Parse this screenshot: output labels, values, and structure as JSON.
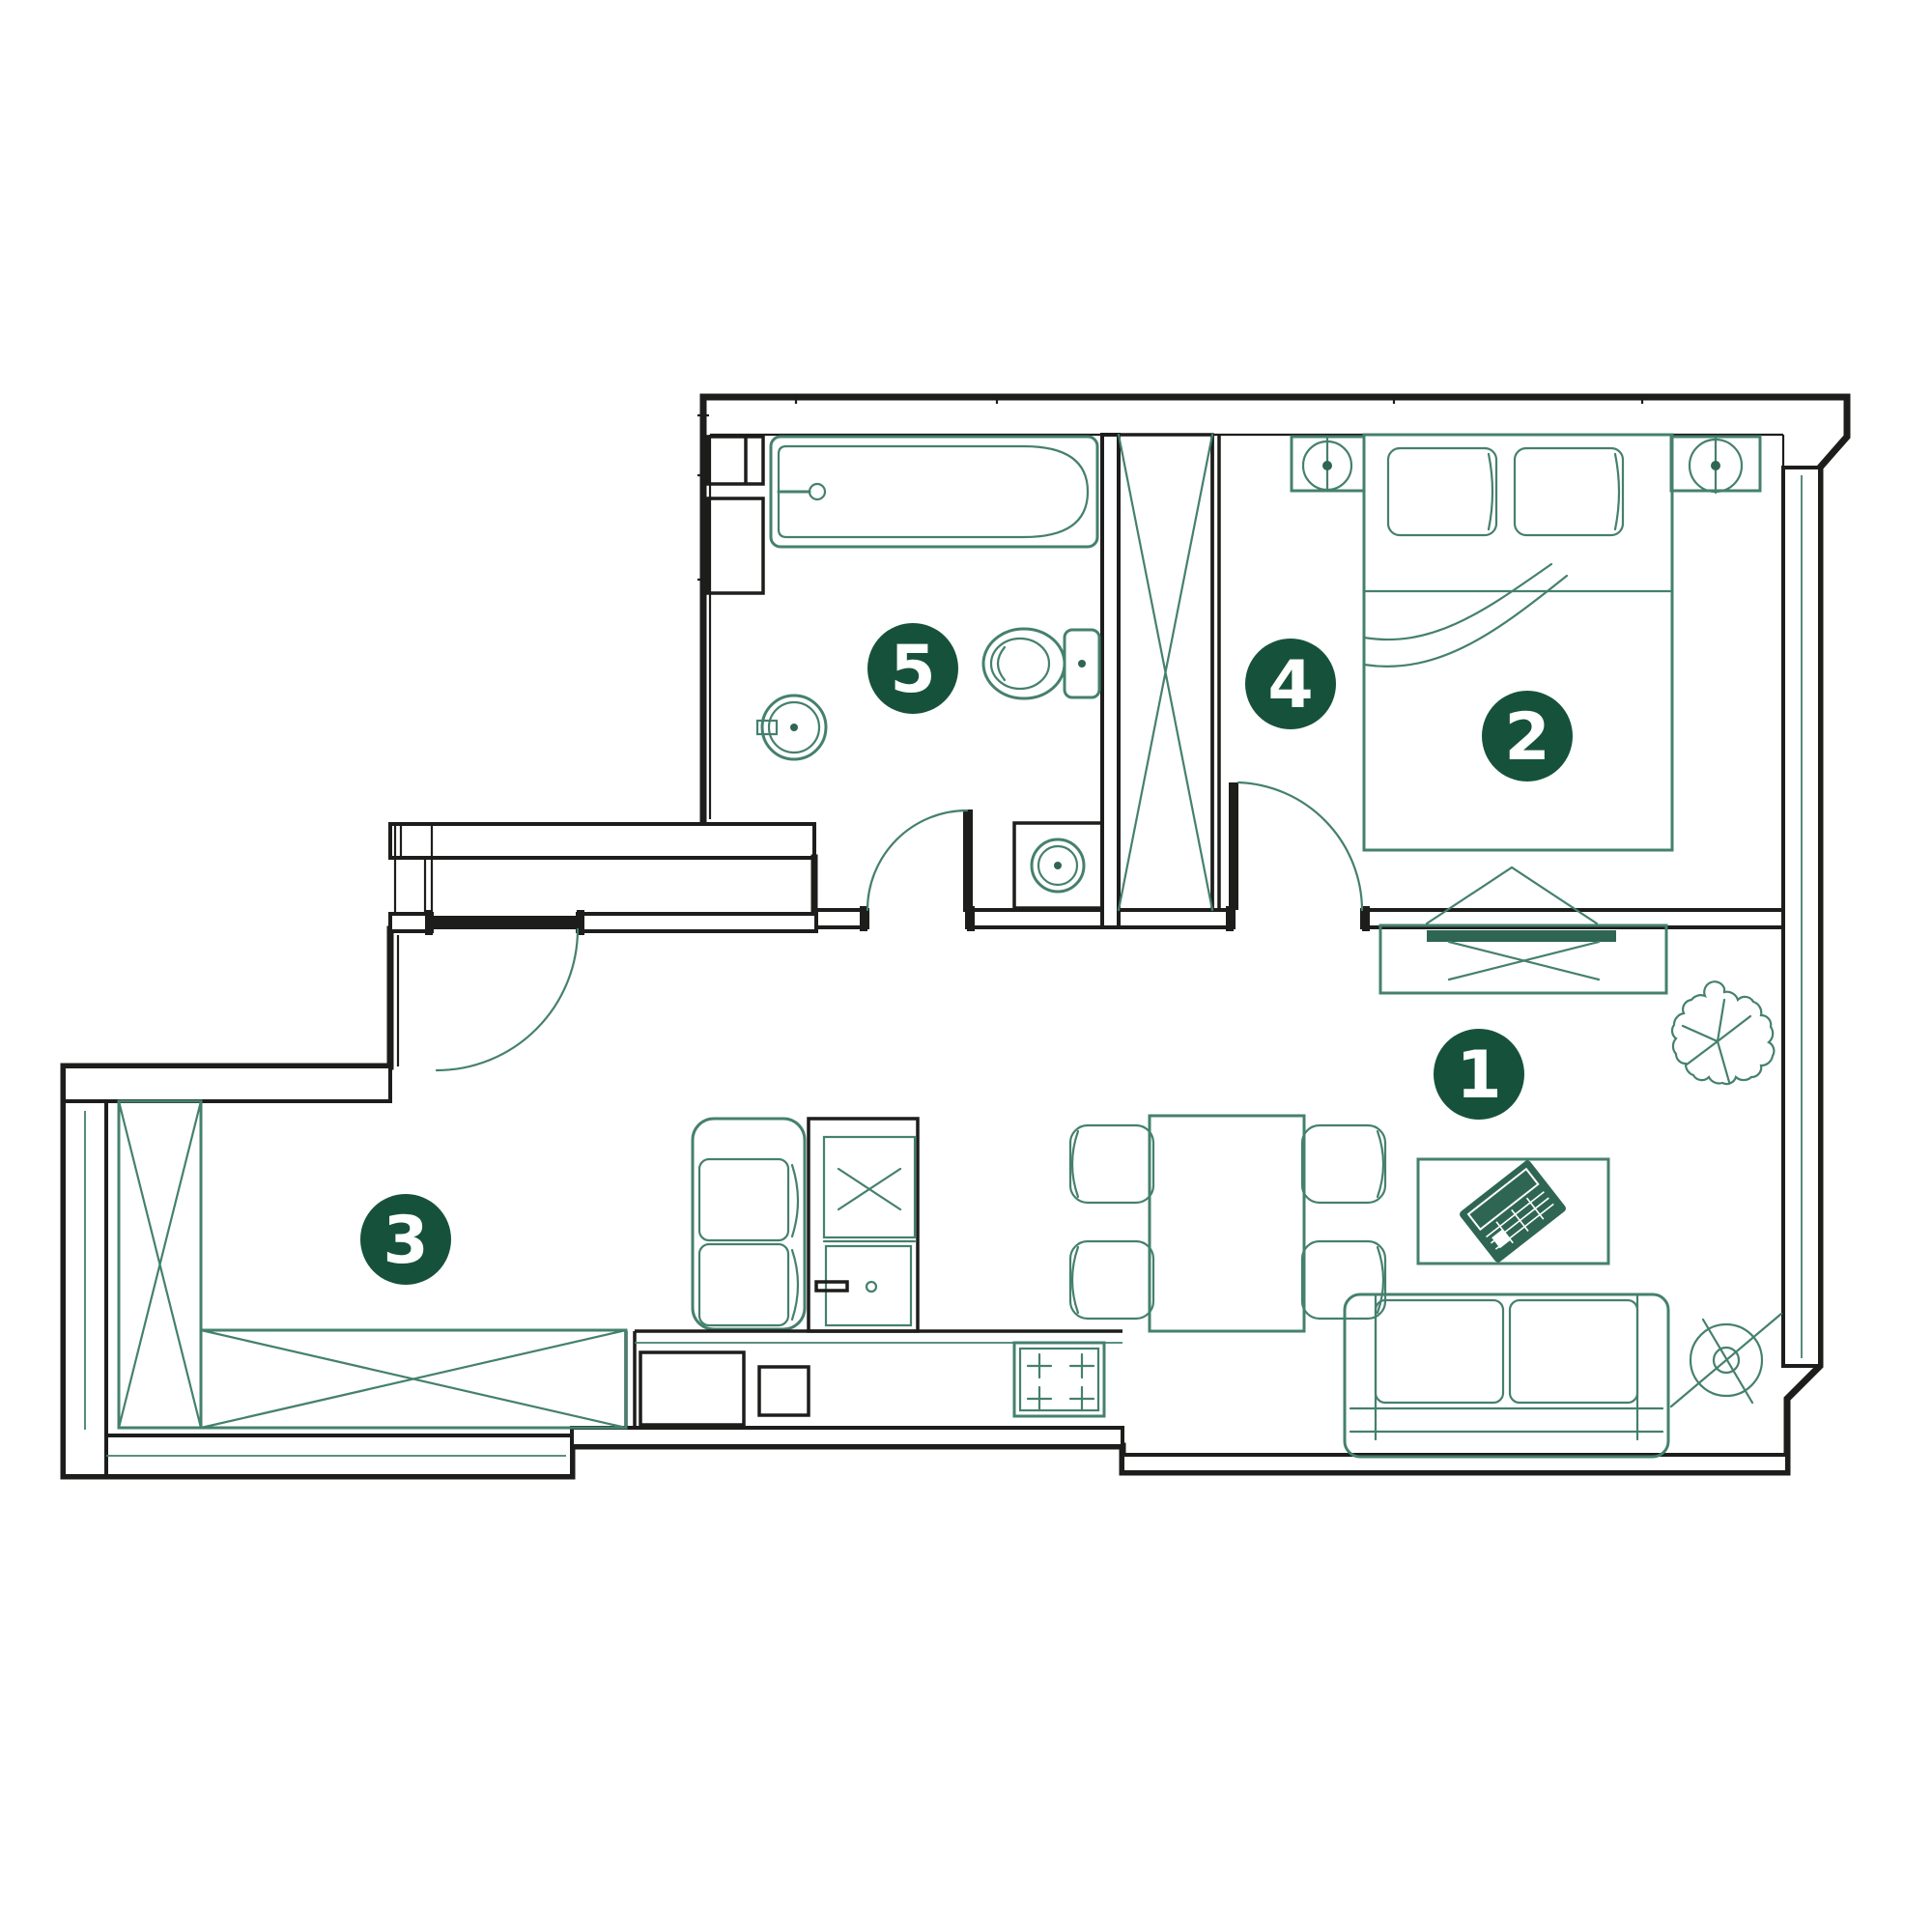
{
  "plan": {
    "rooms": [
      {
        "label": "1",
        "name": "living-room"
      },
      {
        "label": "2",
        "name": "bedroom"
      },
      {
        "label": "3",
        "name": "entry-hall"
      },
      {
        "label": "4",
        "name": "dressing-area"
      },
      {
        "label": "5",
        "name": "bathroom"
      }
    ],
    "palette": {
      "wall": "#1d1d1b",
      "furniture": "#45806e",
      "marker_background": "#16523b",
      "marker_text": "#ffffff",
      "background": "#ffffff"
    }
  }
}
